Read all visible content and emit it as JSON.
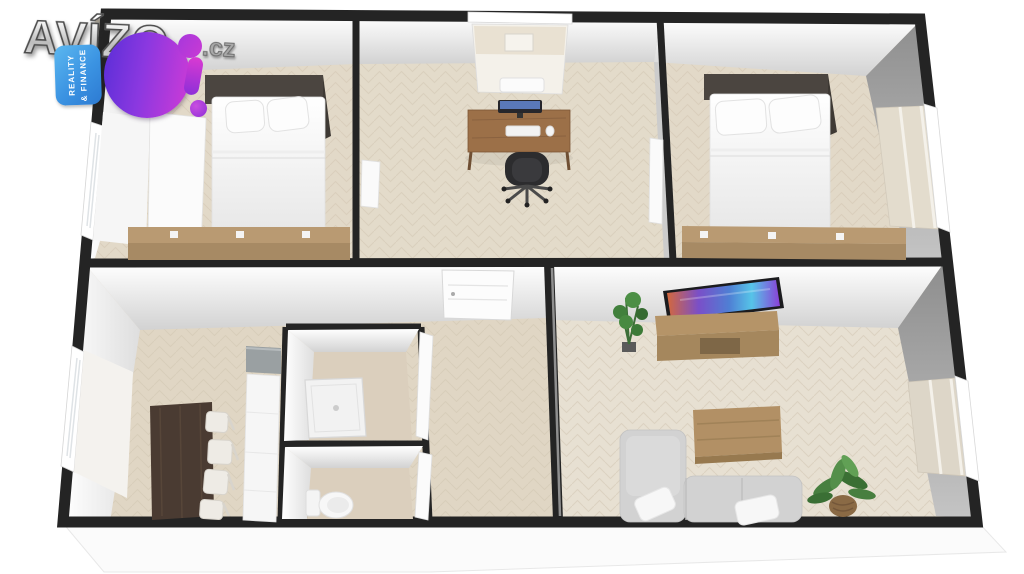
{
  "watermark": {
    "brand": "AVÍZO",
    "tld": ".cz",
    "badge": "BO!",
    "badge_vertical_text_line1": "REALITY",
    "badge_vertical_text_line2": "& FINANCE",
    "colors": {
      "badge_blue": "#3b93e2",
      "badge_violet": "#5f2fd8",
      "badge_magenta": "#c13ad8",
      "brand_metal_gray": "#c9c9c9"
    }
  },
  "scene": {
    "type": "3d-floorplan-render",
    "palette": {
      "wall_top": "#242424",
      "wall_face_white": "#f2f2f2",
      "wall_face_gray": "#9a9a9a",
      "floor_parquet": "#e2d9c8",
      "floor_living": "#e7e0d2",
      "floor_bath": "#dbcfbd",
      "wood_sideboard": "#b99a72",
      "wood_desk": "#9c7048",
      "wood_dark_table": "#4a3b32",
      "headboard_dark": "#4b4540",
      "sofa_gray": "#d2d2d2",
      "plant_green": "#41803c",
      "tv_screen_blue": "#4f7fd4",
      "tv_screen_purple": "#8a3fd8",
      "tv_screen_orange": "#d4683c"
    },
    "rooms": [
      {
        "name": "bedroom-top-left",
        "furniture": [
          "dark-headboard",
          "double-bed",
          "pillows",
          "wood-sideboard",
          "window-left-wall",
          "curtain-panel"
        ]
      },
      {
        "name": "office-top-middle",
        "furniture": [
          "desk",
          "monitor",
          "keyboard",
          "mouse",
          "office-chair",
          "window-top-wall",
          "open-door-leaf"
        ]
      },
      {
        "name": "bedroom-top-right",
        "furniture": [
          "dark-headboard",
          "double-bed",
          "pillows",
          "wood-sideboard",
          "window-right-wall",
          "open-door-leaf"
        ]
      },
      {
        "name": "kitchen-dining-bottom-left",
        "furniture": [
          "dark-dining-table",
          "white-chairs",
          "gray-counter",
          "white-counter-run",
          "window-left-wall"
        ]
      },
      {
        "name": "hallway",
        "furniture": [
          "entrance-door"
        ]
      },
      {
        "name": "bathroom-shower-room",
        "furniture": [
          "shower-tray",
          "door-leaf"
        ]
      },
      {
        "name": "wc",
        "furniture": [
          "toilet",
          "door-leaf"
        ]
      },
      {
        "name": "living-room-bottom-right",
        "furniture": [
          "wall-tv",
          "tv-stand",
          "potted-plant-small",
          "coffee-table",
          "corner-sofa",
          "sofa-pillows",
          "potted-plant-large",
          "window-right-wall"
        ]
      }
    ]
  }
}
